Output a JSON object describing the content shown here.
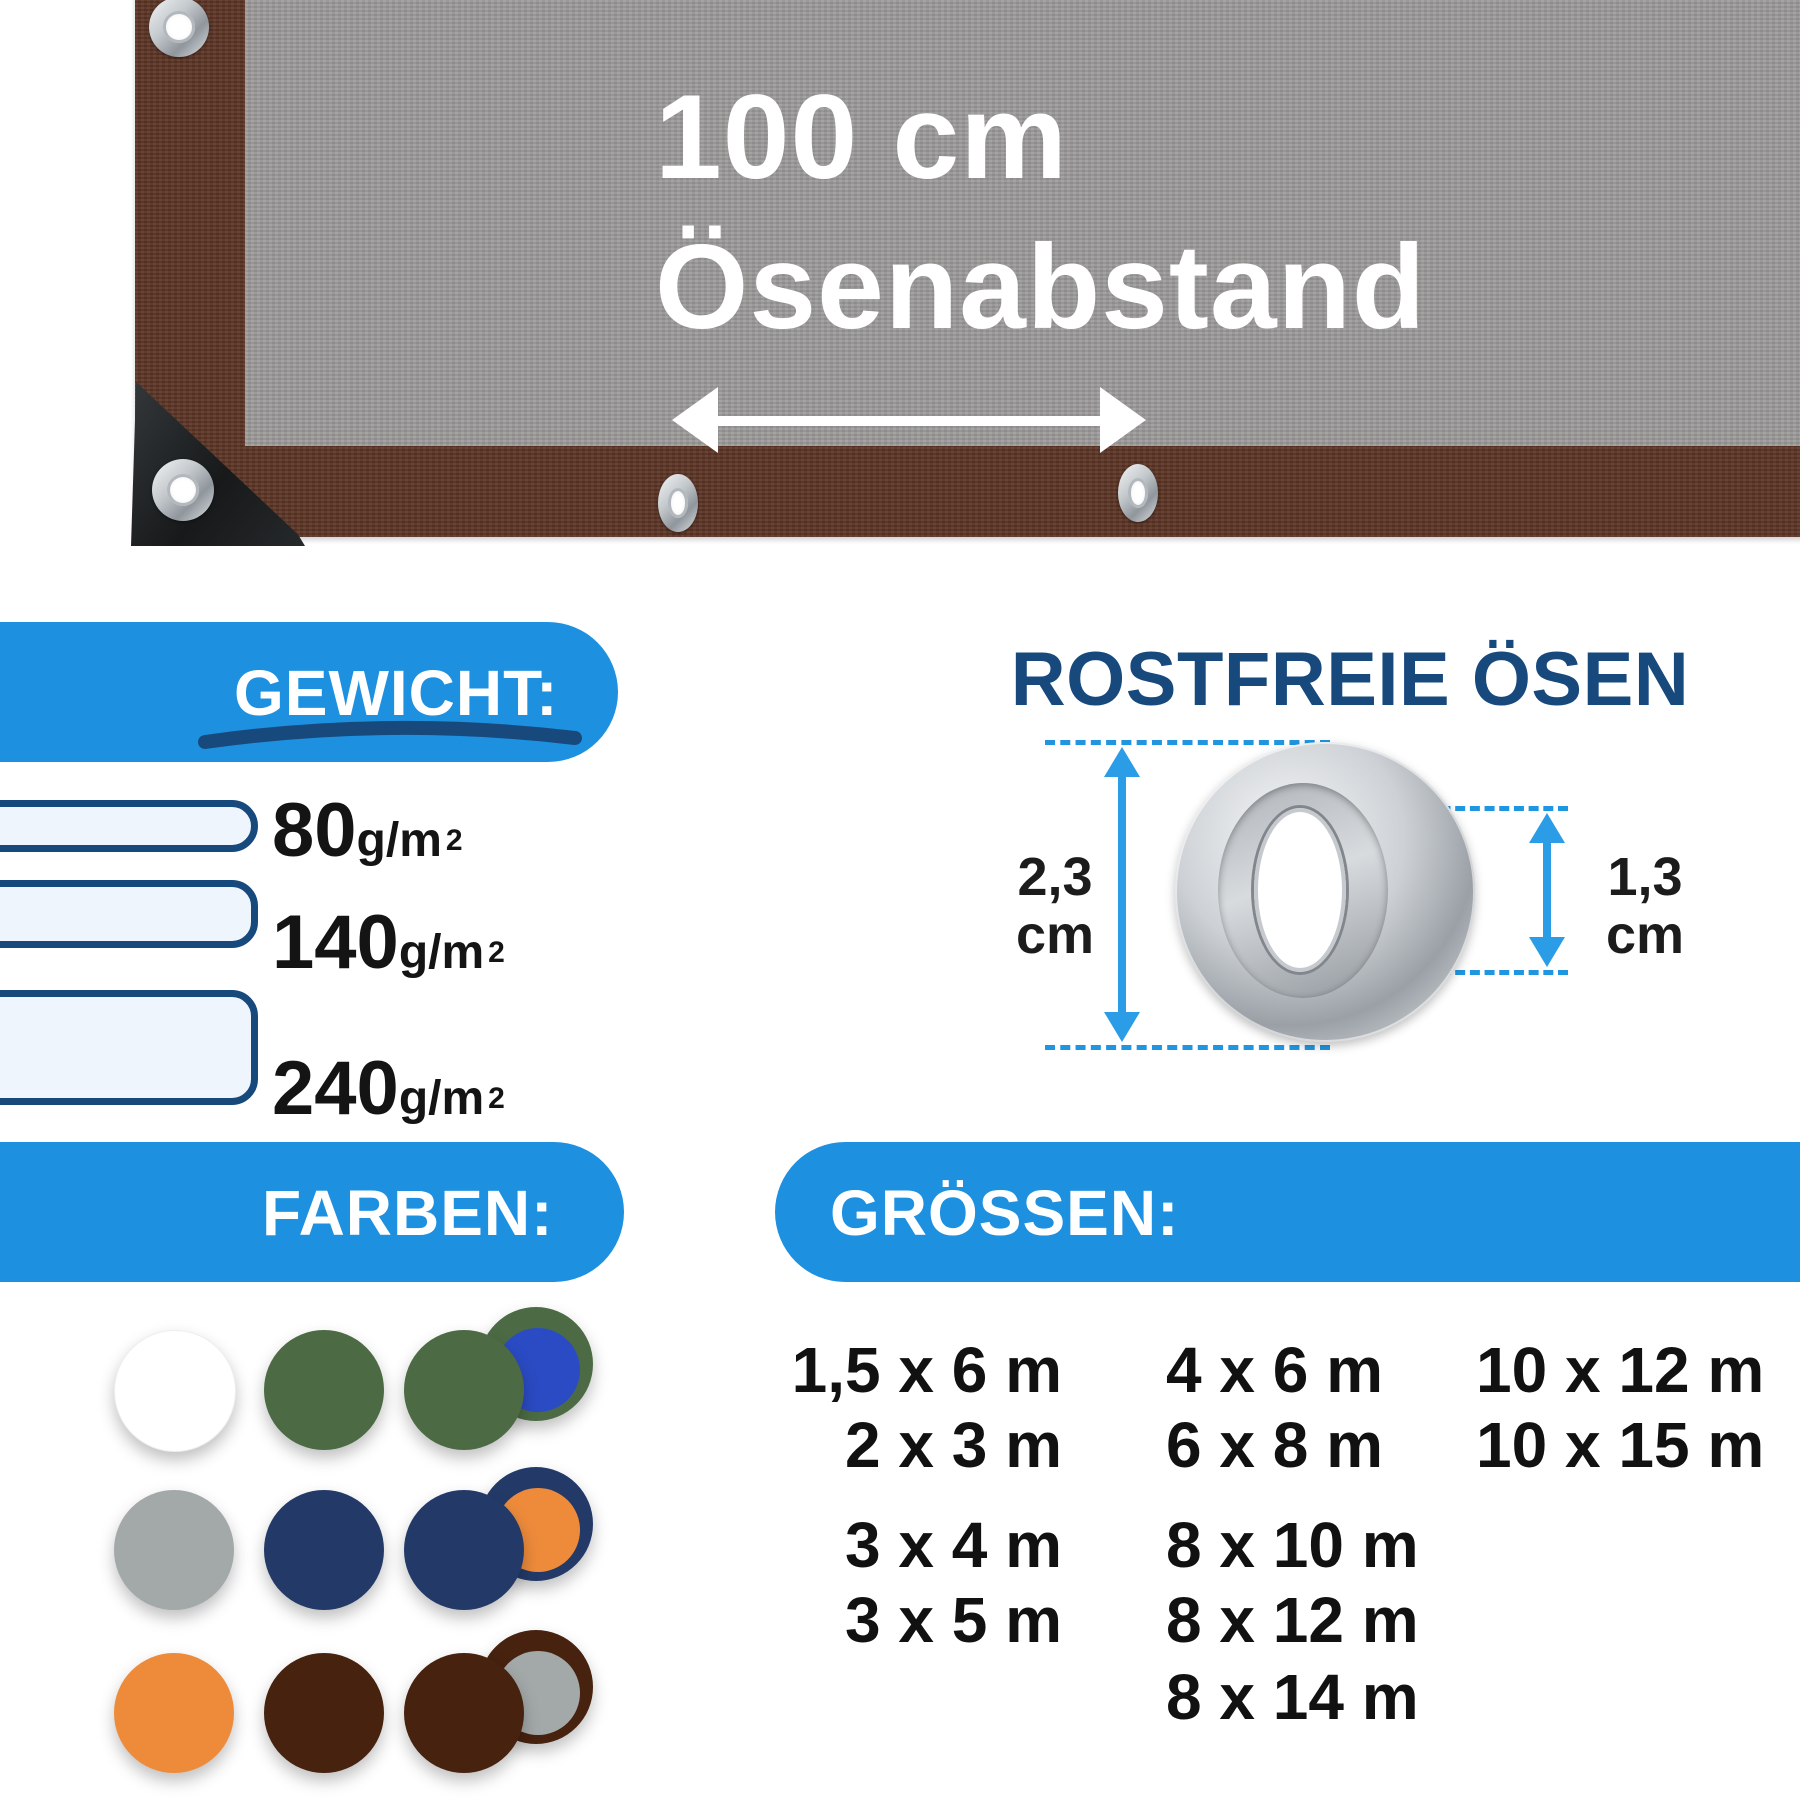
{
  "tarp": {
    "distance_line1": "100 cm",
    "distance_line2": "Ösenabstand",
    "fabric_color": "#9b9a99",
    "border_color": "#5b3424"
  },
  "weight": {
    "title": "GEWICHT:",
    "unit": "g/m",
    "unit_sup": "2",
    "items": [
      {
        "value": "80"
      },
      {
        "value": "140"
      },
      {
        "value": "240"
      }
    ],
    "banner_color": "#1e90e0",
    "bar_border_color": "#17497d",
    "bar_fill_color": "#eef5fc"
  },
  "eyelet_section": {
    "title": "ROSTFREIE ÖSEN",
    "outer_value": "2,3",
    "outer_unit": "cm",
    "inner_value": "1,3",
    "inner_unit": "cm",
    "accent_color": "#2b9ce6",
    "dash_color": "#2196e0"
  },
  "colors_section": {
    "title": "FARBEN:",
    "swatches": [
      {
        "name": "weiss",
        "hex": "#ffffff"
      },
      {
        "name": "gruen",
        "hex": "#4c6b44"
      },
      {
        "name": "gruen-blau",
        "hex": "#4c6b44",
        "hex2": "#2b4bc4"
      },
      {
        "name": "grau",
        "hex": "#a3a9a8"
      },
      {
        "name": "marineblau",
        "hex": "#233a69"
      },
      {
        "name": "marineblau-orange",
        "hex": "#233a69",
        "hex2": "#ee8b3b"
      },
      {
        "name": "orange",
        "hex": "#ee8b3b"
      },
      {
        "name": "braun",
        "hex": "#46220f"
      },
      {
        "name": "braun-grau",
        "hex": "#46220f",
        "hex2": "#a3a9a8"
      }
    ]
  },
  "sizes_section": {
    "title": "GRÖSSEN:",
    "col1": [
      "1,5 x 6 m",
      "2 x 3 m",
      "3 x 4 m",
      "3 x 5 m"
    ],
    "col2": [
      "4 x 6 m",
      "6 x 8 m",
      "8 x 10 m",
      "8 x 12 m",
      "8 x 14 m"
    ],
    "col3": [
      "10 x 12 m",
      "10 x 15 m"
    ]
  }
}
